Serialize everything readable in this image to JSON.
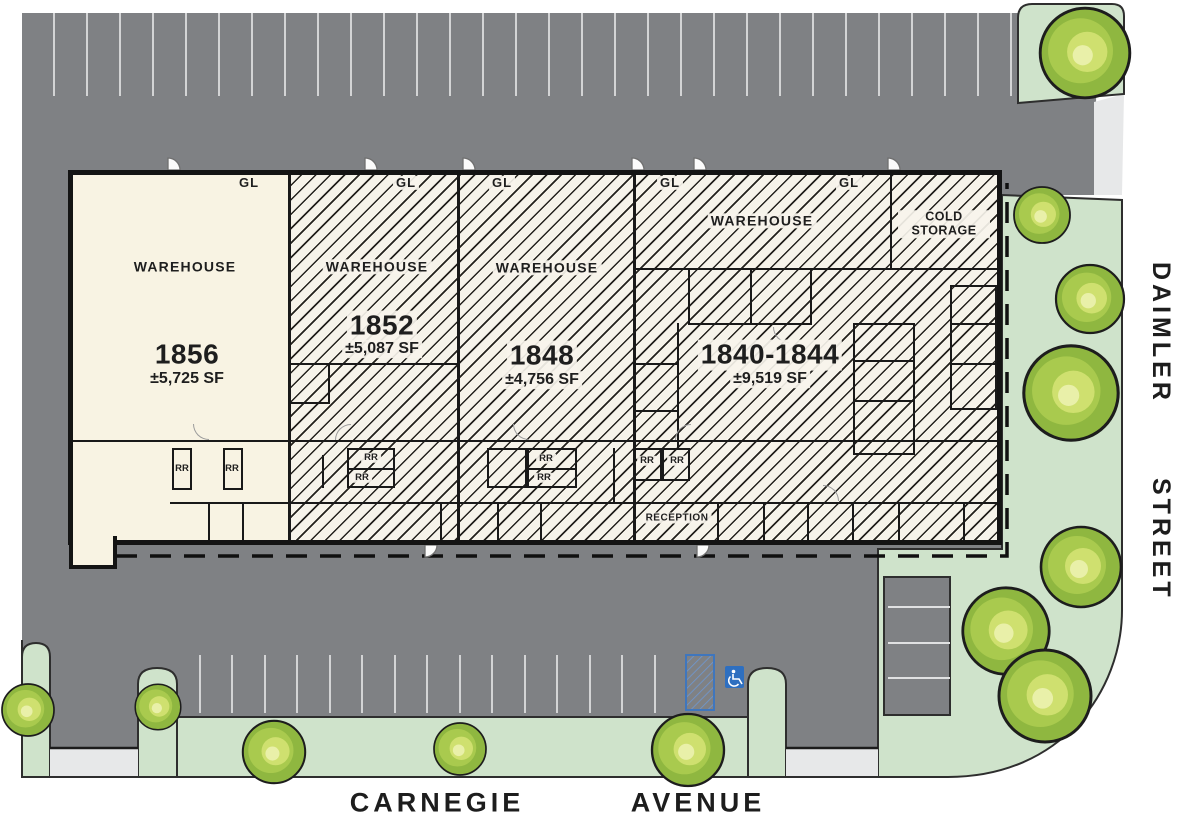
{
  "site_plan": {
    "streets": {
      "side_name": "DAIMLER",
      "side_type": "STREET",
      "bottom_name": "CARNEGIE",
      "bottom_type": "AVENUE"
    },
    "units": [
      {
        "number": "1856",
        "area": "±5,725 SF",
        "label": "WAREHOUSE"
      },
      {
        "number": "1852",
        "area": "±5,087 SF",
        "label": "WAREHOUSE"
      },
      {
        "number": "1848",
        "area": "±4,756 SF",
        "label": "WAREHOUSE"
      },
      {
        "number": "1840-1844",
        "area": "±9,519 SF",
        "label": "WAREHOUSE"
      }
    ],
    "room_labels": {
      "cold_storage": "COLD STORAGE",
      "reception": "RECEPTION",
      "restroom": "RR",
      "grade_level_door": "GL"
    },
    "colors": {
      "asphalt": "#7f8184",
      "landscape_green": "#cfe3cb",
      "building_fill": "#f8f3e3",
      "accessible_blue": "#2e6fc0",
      "stall_line": "#d3d4d5",
      "street_white": "#ffffff"
    }
  }
}
